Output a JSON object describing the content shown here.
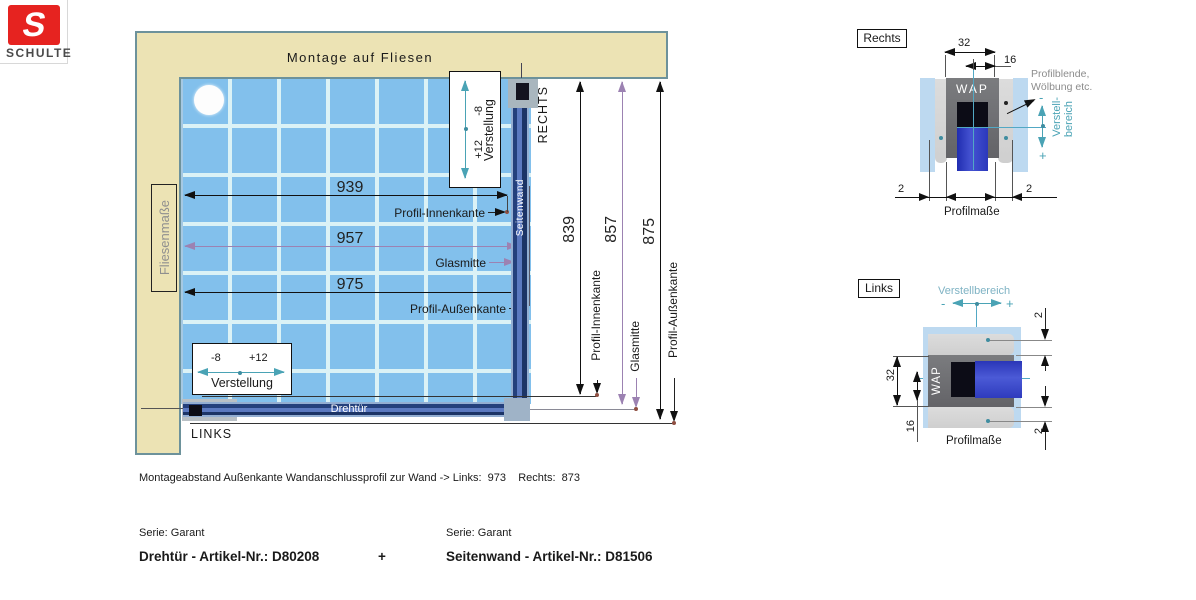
{
  "logo": {
    "letter": "S",
    "brand": "SCHULTE"
  },
  "plan": {
    "wall_top_label": "Montage auf Fliesen",
    "wall_left_label": "Fliesenmaße",
    "right_marker": "RECHTS",
    "left_marker": "LINKS",
    "door_label": "Drehtür",
    "sidewall_label": "Seitenwand",
    "h_dims": {
      "innen": "939",
      "glas": "957",
      "aussen": "975"
    },
    "v_dims": {
      "innen": "839",
      "glas": "857",
      "aussen": "875"
    },
    "pointer_innen": "Profil-Innenkante",
    "pointer_glas": "Glasmitte",
    "pointer_aussen": "Profil-Außenkante",
    "adjust": {
      "minus": "-8",
      "plus": "+12",
      "label": "Verstellung"
    }
  },
  "detail_rechts": {
    "title": "Rechts",
    "width": "32",
    "half_width": "16",
    "profile": "WAP",
    "note_line1": "Profilblende,",
    "note_line2": "Wölbung etc.",
    "minus": "-",
    "plus": "+",
    "adjust_line1": "Verstell-",
    "adjust_line2": "bereich",
    "gap_left": "2",
    "gap_right": "2",
    "caption": "Profilmaße"
  },
  "detail_links": {
    "title": "Links",
    "adjust_label": "Verstellbereich",
    "minus": "-",
    "plus": "+",
    "profile": "WAP",
    "height": "32",
    "half_height": "16",
    "gap_top": "2",
    "gap_bottom": "2",
    "caption": "Profilmaße"
  },
  "footer": {
    "mounting_note": "Montageabstand Außenkante Wandanschlussprofil zur Wand -> Links:  973    Rechts:  873",
    "series_left": "Serie: Garant",
    "series_right": "Serie: Garant",
    "article_left": "Drehtür - Artikel-Nr.: D80208",
    "plus": "+",
    "article_right": "Seitenwand - Artikel-Nr.: D81506"
  },
  "colors": {
    "logo_red": "#e62320",
    "wall_beige": "#ece3b4",
    "wall_border": "#6d929b",
    "tile_blue": "#82c0ec",
    "grout": "#dbf2f6",
    "profile_navy": "#1c3466",
    "profile_light": "#5b79c0",
    "accent_teal": "#4aa3b5",
    "accent_purple": "#9c82b2",
    "glass_blue": "#2a36b8"
  }
}
